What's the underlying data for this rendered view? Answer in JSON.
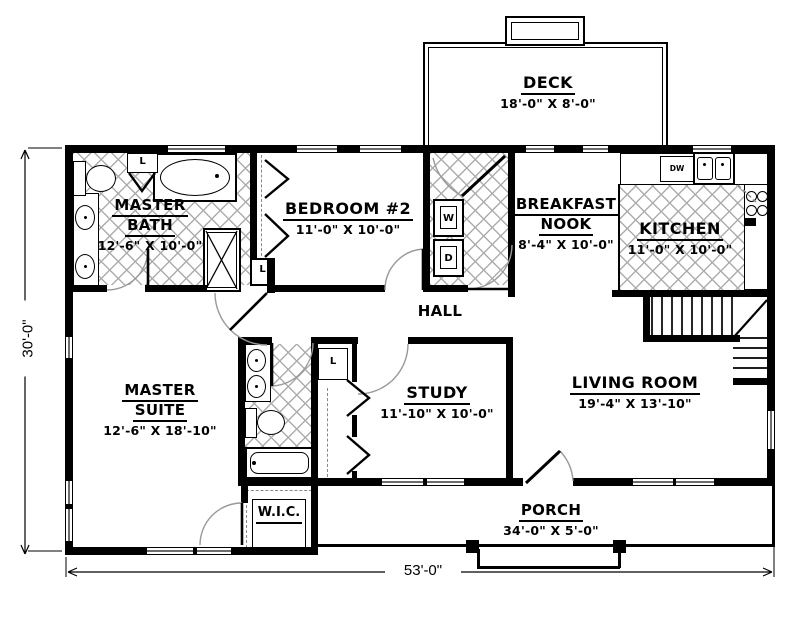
{
  "dimensions": {
    "width_label": "53'-0\"",
    "height_label": "30'-0\""
  },
  "rooms": {
    "deck": {
      "name": "DECK",
      "dims": "18'-0\" X 8'-0\""
    },
    "master_bath": {
      "line1": "MASTER",
      "line2": "BATH",
      "dims": "12'-6\" X 10'-0\""
    },
    "bedroom2": {
      "name": "BEDROOM #2",
      "dims": "11'-0\" X 10'-0\""
    },
    "breakfast_nook": {
      "line1": "BREAKFAST",
      "line2": "NOOK",
      "dims": "8'-4\" X 10'-0\""
    },
    "kitchen": {
      "name": "KITCHEN",
      "dims": "11'-0\" X 10'-0\""
    },
    "hall": {
      "name": "HALL"
    },
    "master_suite": {
      "line1": "MASTER",
      "line2": "SUITE",
      "dims": "12'-6\" X 18'-10\""
    },
    "study": {
      "name": "STUDY",
      "dims": "11'-10\" X 10'-0\""
    },
    "living_room": {
      "name": "LIVING ROOM",
      "dims": "19'-4\" X 13'-10\""
    },
    "wic": {
      "name": "W.I.C."
    },
    "porch": {
      "name": "PORCH",
      "dims": "34'-0\" X 5'-0\""
    }
  },
  "appliances": {
    "washer": "W",
    "dryer": "D",
    "dishwasher": "DW"
  },
  "closets": {
    "linen_bath": "L",
    "linen_hall": "L",
    "linen_study": "L"
  },
  "colors": {
    "wall": "#000000",
    "tile_line": "#adadad",
    "arc": "#999999",
    "background": "#ffffff"
  }
}
